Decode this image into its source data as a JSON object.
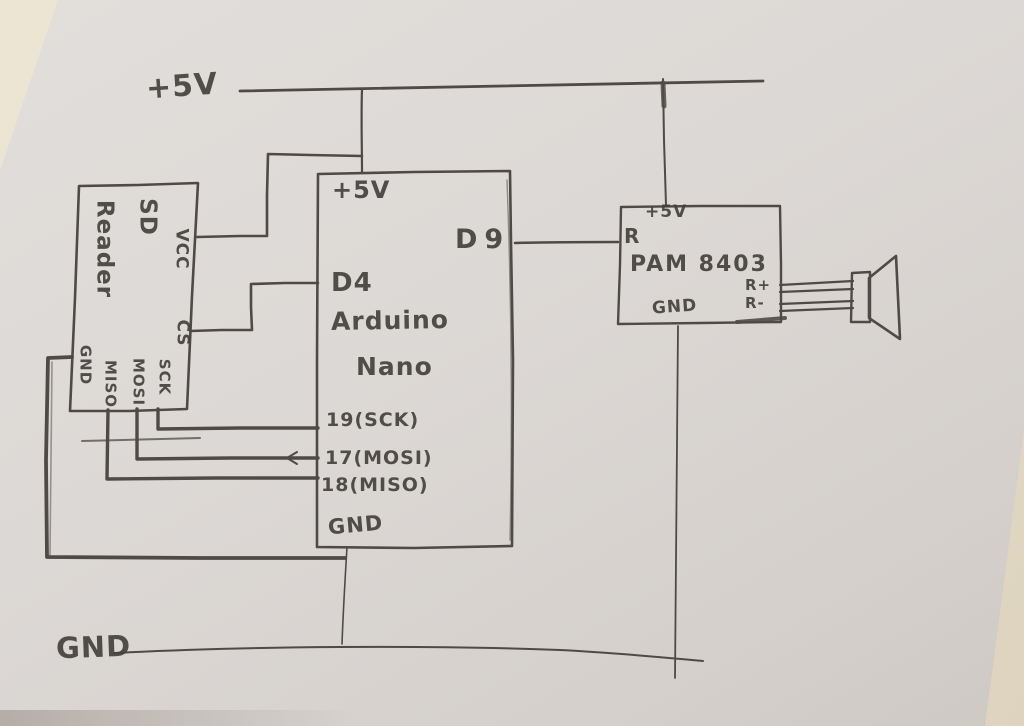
{
  "colors": {
    "pencil": "#4f4a46",
    "paper": "#dcd8d4",
    "surface": "#eae2d0"
  },
  "rails": {
    "top": "+5V",
    "bottom": "GND"
  },
  "sd_reader": {
    "title_line1": "SD",
    "title_line2": "Reader",
    "pin_vcc": "VCC",
    "pin_cs": "CS",
    "pin_sck": "SCK",
    "pin_mosi": "MOSI",
    "pin_miso": "MISO",
    "pin_gnd": "GND"
  },
  "arduino": {
    "title_line1": "Arduino",
    "title_line2": "Nano",
    "pin_5v": "+5V",
    "pin_d9": "D9",
    "pin_d4": "D4",
    "pin_19": "19(SCK)",
    "pin_17": "17(MOSI)",
    "pin_18": "18(MISO)",
    "pin_gnd": "GND"
  },
  "amplifier": {
    "title": "PAM 8403",
    "pin_5v": "+5V",
    "pin_r": "R",
    "pin_rplus": "R+",
    "pin_rminus": "R-",
    "pin_gnd": "GND"
  },
  "speaker": {
    "name": "speaker"
  },
  "connections": [
    "+5V rail -> Arduino +5V",
    "+5V rail -> PAM8403 +5V",
    "SD Reader VCC -> +5V rail",
    "SD Reader CS -> Arduino D4",
    "SD Reader SCK -> Arduino 19(SCK)",
    "SD Reader MOSI -> Arduino 17(MOSI)",
    "SD Reader MISO -> Arduino 18(MISO)",
    "SD Reader GND -> GND rail",
    "Arduino D9 -> PAM8403 R",
    "Arduino GND -> GND rail",
    "PAM8403 GND -> GND rail",
    "PAM8403 R+ -> Speaker",
    "PAM8403 R- -> Speaker"
  ]
}
